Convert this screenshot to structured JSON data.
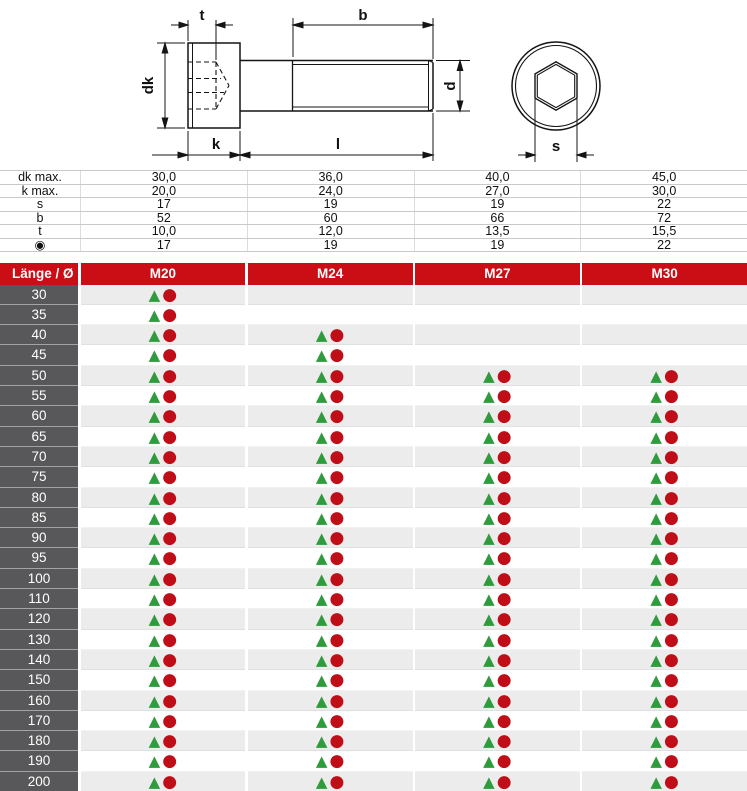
{
  "drawing": {
    "labels": {
      "t": "t",
      "b": "b",
      "dk": "dk",
      "d": "d",
      "k": "k",
      "l": "l",
      "s": "s"
    }
  },
  "spec_table": {
    "rows": [
      {
        "label": "dk max.",
        "values": [
          "30,0",
          "36,0",
          "40,0",
          "45,0"
        ]
      },
      {
        "label": "k max.",
        "values": [
          "20,0",
          "24,0",
          "27,0",
          "30,0"
        ]
      },
      {
        "label": "s",
        "values": [
          "17",
          "19",
          "19",
          "22"
        ]
      },
      {
        "label": "b",
        "values": [
          "52",
          "60",
          "66",
          "72"
        ]
      },
      {
        "label": "t",
        "values": [
          "10,0",
          "12,0",
          "13,5",
          "15,5"
        ]
      },
      {
        "label": "◉",
        "values": [
          "17",
          "19",
          "19",
          "22"
        ]
      }
    ]
  },
  "main_table": {
    "header": {
      "label": "Länge / Ø",
      "columns": [
        "M20",
        "M24",
        "M27",
        "M30"
      ]
    },
    "markers": {
      "triangle": "▲",
      "circle": "●"
    },
    "rows": [
      {
        "length": "30",
        "available": [
          true,
          false,
          false,
          false
        ]
      },
      {
        "length": "35",
        "available": [
          true,
          false,
          false,
          false
        ]
      },
      {
        "length": "40",
        "available": [
          true,
          true,
          false,
          false
        ]
      },
      {
        "length": "45",
        "available": [
          true,
          true,
          false,
          false
        ]
      },
      {
        "length": "50",
        "available": [
          true,
          true,
          true,
          true
        ]
      },
      {
        "length": "55",
        "available": [
          true,
          true,
          true,
          true
        ]
      },
      {
        "length": "60",
        "available": [
          true,
          true,
          true,
          true
        ]
      },
      {
        "length": "65",
        "available": [
          true,
          true,
          true,
          true
        ]
      },
      {
        "length": "70",
        "available": [
          true,
          true,
          true,
          true
        ]
      },
      {
        "length": "75",
        "available": [
          true,
          true,
          true,
          true
        ]
      },
      {
        "length": "80",
        "available": [
          true,
          true,
          true,
          true
        ]
      },
      {
        "length": "85",
        "available": [
          true,
          true,
          true,
          true
        ]
      },
      {
        "length": "90",
        "available": [
          true,
          true,
          true,
          true
        ]
      },
      {
        "length": "95",
        "available": [
          true,
          true,
          true,
          true
        ]
      },
      {
        "length": "100",
        "available": [
          true,
          true,
          true,
          true
        ]
      },
      {
        "length": "110",
        "available": [
          true,
          true,
          true,
          true
        ]
      },
      {
        "length": "120",
        "available": [
          true,
          true,
          true,
          true
        ]
      },
      {
        "length": "130",
        "available": [
          true,
          true,
          true,
          true
        ]
      },
      {
        "length": "140",
        "available": [
          true,
          true,
          true,
          true
        ]
      },
      {
        "length": "150",
        "available": [
          true,
          true,
          true,
          true
        ]
      },
      {
        "length": "160",
        "available": [
          true,
          true,
          true,
          true
        ]
      },
      {
        "length": "170",
        "available": [
          true,
          true,
          true,
          true
        ]
      },
      {
        "length": "180",
        "available": [
          true,
          true,
          true,
          true
        ]
      },
      {
        "length": "190",
        "available": [
          true,
          true,
          true,
          true
        ]
      },
      {
        "length": "200",
        "available": [
          true,
          true,
          true,
          true
        ]
      }
    ]
  },
  "colors": {
    "header_red": "#cb0e15",
    "label_cell_gray": "#58585a",
    "row_shade": "#ececec",
    "marker_green": "#2e9b3c",
    "marker_red": "#bf0e18"
  }
}
